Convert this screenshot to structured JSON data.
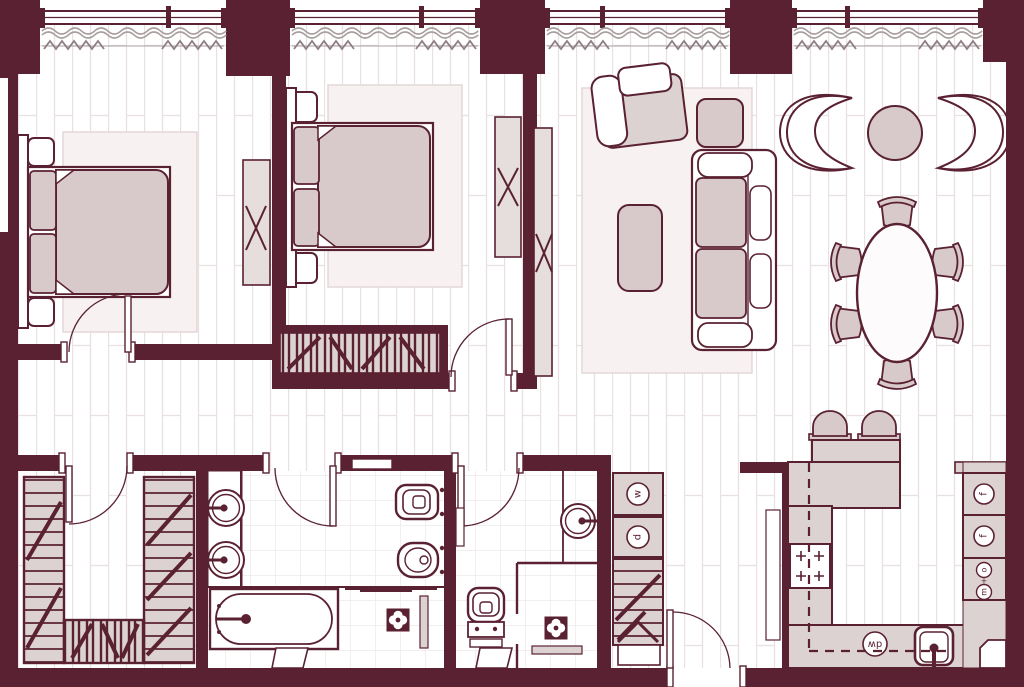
{
  "type": "apartment-floor-plan",
  "appliance_labels": {
    "washer": "w",
    "dryer": "d",
    "fridge": "f",
    "freezer": "f",
    "oven": "o",
    "plus_sign": "+",
    "microwave": "m",
    "dishwasher": "dw"
  },
  "colors": {
    "wall": "#5a2132",
    "line": "#5a2132",
    "counter": "#ddd2d2",
    "furniture": "#d8c9ca",
    "panel": "#e6dddd",
    "rug": "#f7f1f1",
    "rugBorder": "#e3d7d8",
    "floorLine": "#e9e1e1",
    "tileLine": "#ece5e5",
    "curtain": "#a89e9e",
    "zigzag": "#8e7e83"
  },
  "inventory": {
    "window_bays": 4,
    "rooms": [
      {
        "name": "bedroom-1",
        "items": [
          "double-bed",
          "headboard",
          "nightstand",
          "nightstand",
          "rug",
          "tv-panel"
        ]
      },
      {
        "name": "bedroom-2",
        "items": [
          "double-bed",
          "headboard",
          "nightstand",
          "nightstand",
          "rug",
          "wardrobe",
          "tv-panel",
          "door"
        ]
      },
      {
        "name": "living-room",
        "items": [
          "armchair",
          "ottoman",
          "sofa",
          "coffee-table",
          "lounge-chair",
          "lounge-chair",
          "side-table",
          "dining-table",
          "dining-chairs-x6",
          "tv-panel"
        ]
      },
      {
        "name": "walk-in-closet",
        "items": [
          "shelving-unit",
          "shelving-unit",
          "shelving-unit",
          "door"
        ]
      },
      {
        "name": "master-bathroom",
        "items": [
          "vanity-sink",
          "vanity-sink",
          "bathtub",
          "shower",
          "floor-drain",
          "wall-hung-toilet",
          "bidet",
          "door"
        ]
      },
      {
        "name": "guest-bathroom",
        "items": [
          "round-sink",
          "wall-hung-toilet",
          "shower",
          "floor-drain",
          "bench",
          "door"
        ]
      },
      {
        "name": "utility-column",
        "items": [
          "washer",
          "dryer",
          "linen-cabinet"
        ]
      },
      {
        "name": "hallway",
        "items": [
          "entrance-door"
        ]
      },
      {
        "name": "kitchen",
        "items": [
          "peninsula-counter",
          "bar-stool",
          "bar-stool",
          "hob",
          "sink",
          "dishwasher",
          "fridge",
          "freezer",
          "oven-microwave-column",
          "corner-vent"
        ]
      }
    ]
  }
}
